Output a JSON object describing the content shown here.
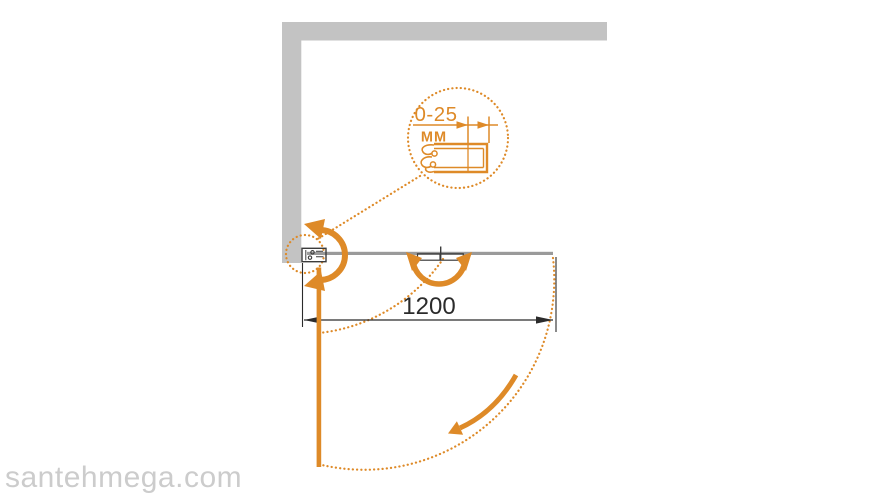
{
  "watermark": {
    "text": "santehmega.com"
  },
  "detail_callout": {
    "range_label": "0-25",
    "unit_label": "ММ"
  },
  "dimension": {
    "width_label": "1200"
  },
  "colors": {
    "accent_orange": "#DE8A28",
    "wall_gray": "#C3C3C3",
    "panel_gray": "#9A9A9A",
    "line_dark": "#3C3C3C",
    "dim_dark": "#2B2B2B",
    "watermark_gray": "#CCCCCC",
    "bg": "#FFFFFF"
  }
}
